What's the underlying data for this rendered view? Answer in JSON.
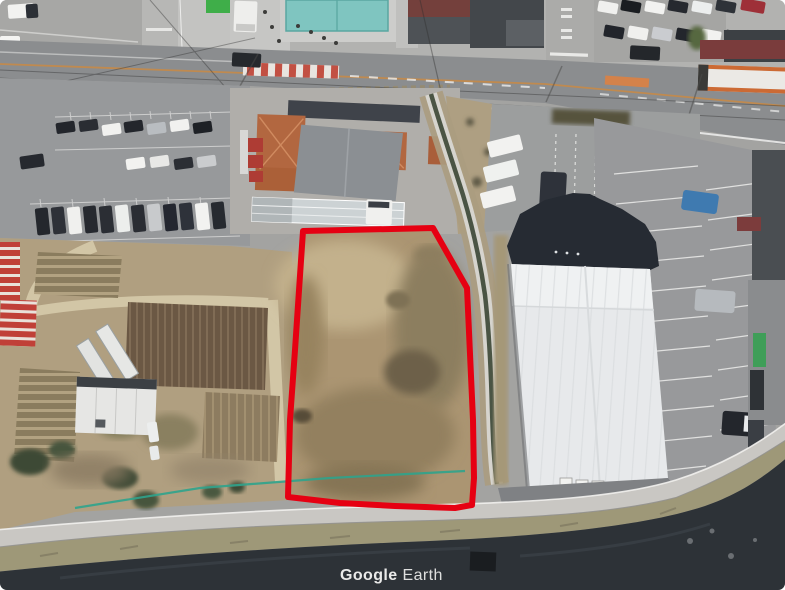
{
  "window": {
    "width": 785,
    "height": 590,
    "app": "Google Earth",
    "view": "oblique aerial satellite imagery"
  },
  "watermark": {
    "brand": "Google",
    "product": "Earth",
    "text": "Google Earth",
    "color": "#f2f2f1"
  },
  "annotation": {
    "label": "highlighted vacant land parcel",
    "shape": "polygon",
    "stroke_color": "#e60012",
    "stroke_width": 6,
    "points": "303,231 433,228 467,288 473,420 474,478 472,505 455,508 395,506 340,503 288,497 290,420 295,350"
  },
  "scene": {
    "description": "Aerial photo: red-outlined brown vacant field bordered by a drainage canal and a white-roofed warehouse to the east, a road with parking lots and an orange tiled-roof building to the north, crop fields and greenhouses to the west, and a river with levee path to the south.",
    "regions": [
      "main-road",
      "left-parking-lot",
      "tiled-roof-building",
      "swimming-pool",
      "crop-fields",
      "greenhouses",
      "vacant-parcel",
      "drainage-canal",
      "warehouse",
      "warehouse-parking",
      "levee-path",
      "river"
    ],
    "palette": {
      "asphalt": "#9a9b99",
      "road": "#8b8d8f",
      "parcel_soil": "#ab9572",
      "river": "#2d3237",
      "levee_path": "#c9c7c3",
      "grass_bank": "#9e9878",
      "pool_water": "#7fc5c0",
      "warehouse_roof": "#e7e9eb",
      "warehouse_dark_roof": "#262b33",
      "tile_roof_orange": "#b26740",
      "greenhouse_stripe_red": "#c04038",
      "canal_water": "#4a5444",
      "fence_teal": "#2fa38c",
      "tilled_field": "#6b5844"
    }
  }
}
